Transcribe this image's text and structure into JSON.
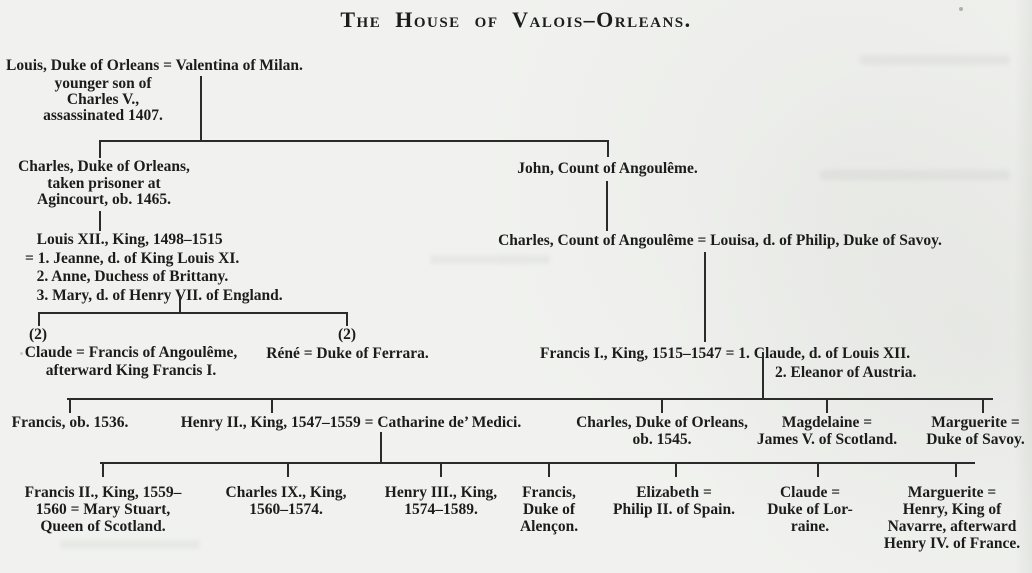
{
  "title": "The House of Valois–Orleans.",
  "colors": {
    "paper": "#f1f2ef",
    "ink": "#1c1c1c",
    "line": "#2b2b2b"
  },
  "tree": {
    "gen1": {
      "couple": "Louis, Duke of Orleans = Valentina of Milan.",
      "note": "younger son of\nCharles V.,\nassassinated 1407."
    },
    "gen2": {
      "charles_duke_of_orleans": "Charles, Duke of Orleans,\ntaken prisoner at\nAgincourt, ob. 1465.",
      "john_count_of_angouleme": "John, Count of Angoulême."
    },
    "gen3": {
      "louis_xii": "   Louis XII., King, 1498–1515\n= 1. Jeanne, d. of King Louis XI.\n   2. Anne, Duchess of Brittany.\n   3. Mary, d. of Henry VII. of England.",
      "charles_count_of_angouleme": "Charles, Count of Angoulême = Louisa, d. of Philip, Duke of Savoy."
    },
    "gen4": {
      "claude_marker": "(2)",
      "claude": "Claude = Francis of Angoulême,\nafterward King Francis I.",
      "rene_marker": "(2)",
      "rene": "Réné = Duke of Ferrara.",
      "francis_i_line1": "Francis I., King, 1515–1547 = 1. Claude, d. of Louis XII.",
      "francis_i_line2": "2. Eleanor of Austria."
    },
    "gen5": {
      "francis": "Francis, ob. 1536.",
      "henry_ii": "Henry II., King, 1547–1559 = Catharine de’ Medici.",
      "charles_duke_of_orleans": "Charles, Duke of Orleans,\nob. 1545.",
      "magdelaine": "Magdelaine =\nJames V. of Scotland.",
      "marguerite": "Marguerite =\nDuke of Savoy."
    },
    "gen6": {
      "francis_ii": "Francis II., King, 1559–\n1560 = Mary Stuart,\nQueen of Scotland.",
      "charles_ix": "Charles IX., King,\n1560–1574.",
      "henry_iii": "Henry III., King,\n1574–1589.",
      "francis_alencon": "Francis,\nDuke of\nAlençon.",
      "elizabeth": "Elizabeth =\nPhilip II. of Spain.",
      "claude": "Claude =\nDuke of Lor-\nraine.",
      "marguerite": "Marguerite =\nHenry, King of\nNavarre, afterward\nHenry IV. of France."
    }
  }
}
